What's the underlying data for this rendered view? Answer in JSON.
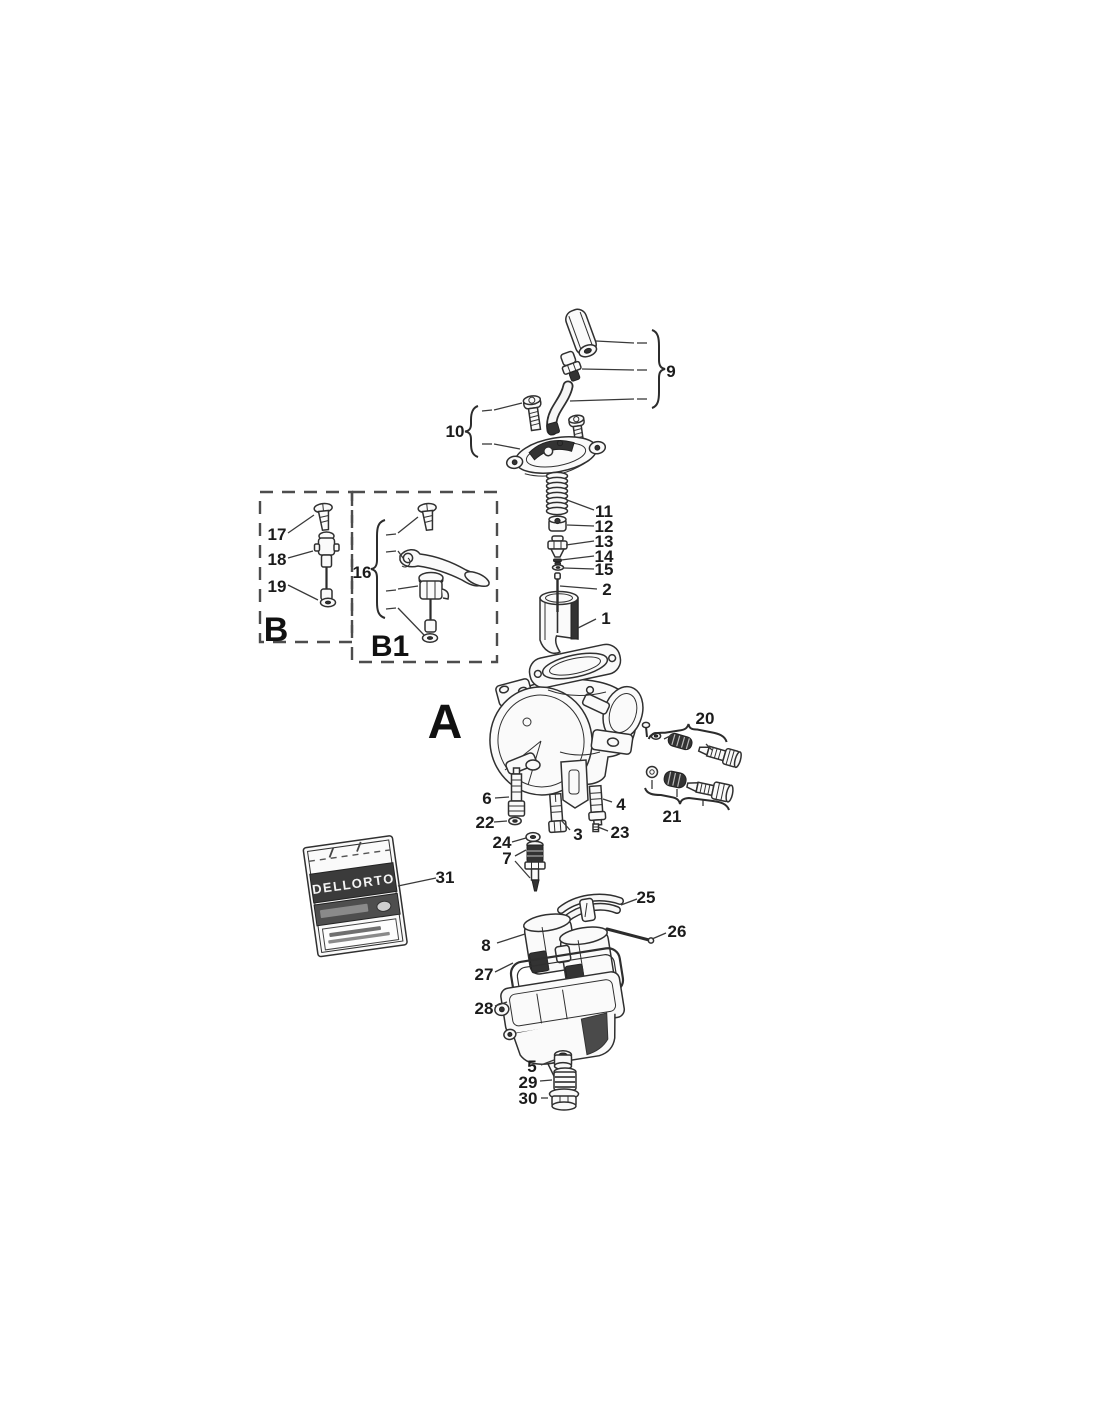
{
  "sections": {
    "a": "A",
    "b": "B",
    "b1": "B1"
  },
  "package": {
    "brand": "DELLORTO"
  },
  "callouts": {
    "c1": "1",
    "c2": "2",
    "c3": "3",
    "c4": "4",
    "c5": "5",
    "c6": "6",
    "c7": "7",
    "c8": "8",
    "c9": "9",
    "c10": "10",
    "c11": "11",
    "c12": "12",
    "c13": "13",
    "c14": "14",
    "c15": "15",
    "c16": "16",
    "c17": "17",
    "c18": "18",
    "c19": "19",
    "c20": "20",
    "c21": "21",
    "c22": "22",
    "c23": "23",
    "c24": "24",
    "c25": "25",
    "c26": "26",
    "c27": "27",
    "c28": "28",
    "c29": "29",
    "c30": "30",
    "c31": "31"
  }
}
